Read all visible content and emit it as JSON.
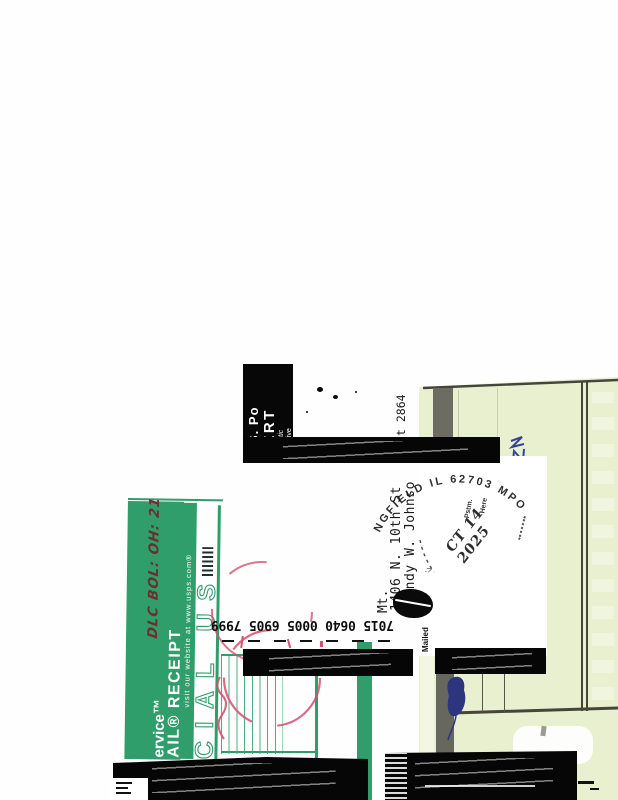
{
  "cert_header": {
    "line1": "U.S. Po",
    "line2": "CERT",
    "line3": "Domestic",
    "line4": "For delive"
  },
  "address": {
    "name": "Randy W. Johnso",
    "street": "1406 N. 10th St",
    "street_fragment": "t  2864",
    "city": "Mt. "
  },
  "postmark": {
    "arc_text": "NGFIELD IL 62703 MPO",
    "pstm_label": "Pstm.",
    "here_label": "Here",
    "date": "CT 14 2025",
    "arrow_fragment": "·>"
  },
  "tracking_number": "7015 0640 0005 6905 7999",
  "receipt": {
    "service_text": "ervice™",
    "title_text": "AIL® RECEIPT",
    "website_text": "visit our website at www.usps.com®",
    "official_use_watermark": "CIAL US",
    "handwritten_note": "DLC BOL: OH: 21"
  },
  "annotations": {
    "mailed_label": "Mailed"
  },
  "colors": {
    "receipt_green": "#2f9e6a",
    "card_green": "#e8f0d0",
    "stamp_red": "#d65070",
    "pen_blue": "#39429b"
  }
}
